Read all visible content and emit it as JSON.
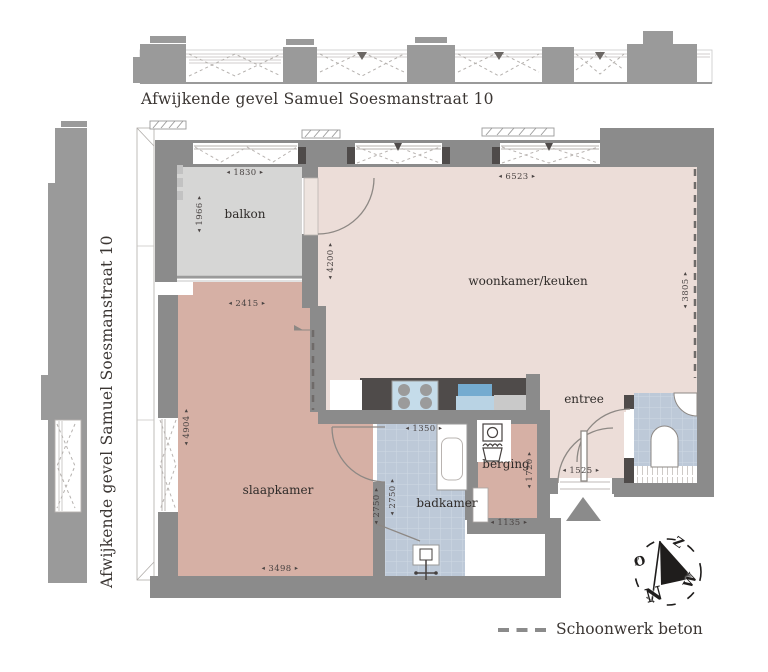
{
  "titles": {
    "top_facade": "Afwijkende gevel Samuel Soesmanstraat 10",
    "left_facade": "Afwijkende gevel Samuel Soesmanstraat 10"
  },
  "legend": {
    "schoonwerk_label": "Schoonwerk beton"
  },
  "compass": {
    "letters": {
      "n": "N",
      "o": "O",
      "z": "Z",
      "w": "W"
    }
  },
  "rooms": [
    {
      "id": "balkon",
      "label": "balkon"
    },
    {
      "id": "woonkamer",
      "label": "woonkamer/keuken"
    },
    {
      "id": "slaapkamer",
      "label": "slaapkamer"
    },
    {
      "id": "badkamer",
      "label": "badkamer"
    },
    {
      "id": "berging",
      "label": "berging"
    },
    {
      "id": "entree",
      "label": "entree"
    }
  ],
  "dimensions_mm": [
    {
      "id": "balkon-breedte",
      "value": "1830"
    },
    {
      "id": "balkon-diepte",
      "value": "1966"
    },
    {
      "id": "woonkamer-breedte",
      "value": "6523"
    },
    {
      "id": "woonkamer-diepte",
      "value": "4200"
    },
    {
      "id": "woonkamer-rechts",
      "value": "3805"
    },
    {
      "id": "slaapkamer-top",
      "value": "2415"
    },
    {
      "id": "slaapkamer-links",
      "value": "4904"
    },
    {
      "id": "slaapkamer-onder",
      "value": "3498"
    },
    {
      "id": "slaapkamer-rechts",
      "value": "2750"
    },
    {
      "id": "badkamer-diepte",
      "value": "2750"
    },
    {
      "id": "badkamer-breedte",
      "value": "1350"
    },
    {
      "id": "berging-diepte",
      "value": "1720"
    },
    {
      "id": "berging-breedte",
      "value": "1135"
    },
    {
      "id": "entree-breedte",
      "value": "1525"
    }
  ],
  "colors": {
    "wall": "#8b8b8b",
    "facade": "#9a9a9a",
    "floor_living": "#ecddd8",
    "floor_bedroom": "#d6b0a5",
    "floor_balcony": "#d6d6d5",
    "tiles": "#bdc9d8",
    "counter_dark": "#4f4b4a",
    "sink_blue": "#74abd0",
    "stove_panel": "#c5dcea",
    "text": "#3b3633",
    "compass": "#1f1d1c"
  }
}
